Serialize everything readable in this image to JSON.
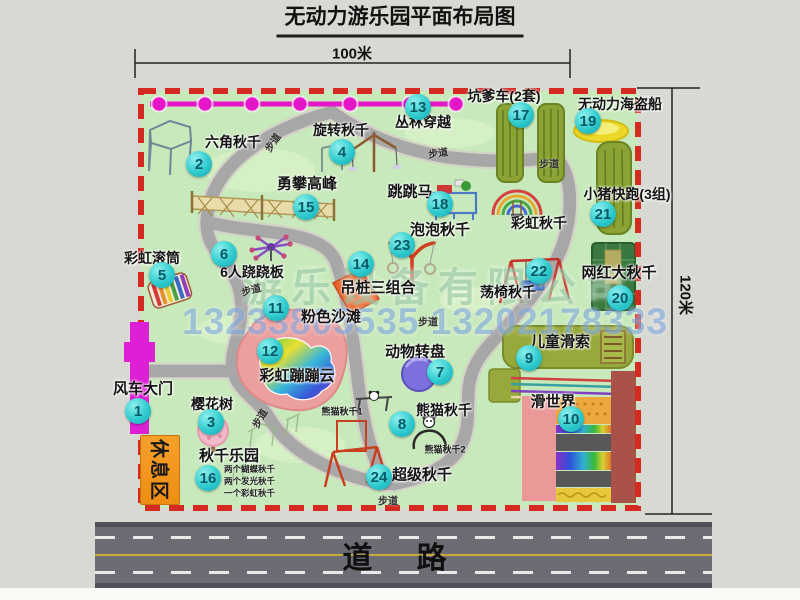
{
  "title": "无动力游乐园平面布局图",
  "dimensions": {
    "width_label": "100米",
    "height_label": "120米"
  },
  "road_label": "道 路",
  "rest_area_label": "休息区",
  "trail_label": "步道",
  "rainbow_swing_label": "彩虹秋千",
  "panda_swing_1": "熊猫秋千1",
  "panda_swing_2": "熊猫秋千2",
  "swing_park_notes": [
    "两个蝴蝶秋千",
    "两个发光秋千",
    "一个彩虹秋千"
  ],
  "watermark": {
    "company": "游乐设备有限公司",
    "phone": "13233805535 13202178333"
  },
  "items": [
    {
      "num": "1",
      "label": "风车大门"
    },
    {
      "num": "2",
      "label": "六角秋千"
    },
    {
      "num": "3",
      "label": "樱花树"
    },
    {
      "num": "4",
      "label": "旋转秋千"
    },
    {
      "num": "5",
      "label": "彩虹滚筒"
    },
    {
      "num": "6",
      "label": "6人跷跷板"
    },
    {
      "num": "7",
      "label": "动物转盘"
    },
    {
      "num": "8",
      "label": "熊猫秋千"
    },
    {
      "num": "9",
      "label": "儿童滑索"
    },
    {
      "num": "10",
      "label": "滑世界"
    },
    {
      "num": "11",
      "label": "粉色沙滩"
    },
    {
      "num": "12",
      "label": "彩虹蹦蹦云"
    },
    {
      "num": "13",
      "label": "丛林穿越"
    },
    {
      "num": "14",
      "label": "吊桩三组合"
    },
    {
      "num": "15",
      "label": "勇攀高峰"
    },
    {
      "num": "16",
      "label": "秋千乐园"
    },
    {
      "num": "17",
      "label": "坑爹车(2套)"
    },
    {
      "num": "18",
      "label": "跳跳马"
    },
    {
      "num": "19",
      "label": "无动力海盗船"
    },
    {
      "num": "20",
      "label": "网红大秋千"
    },
    {
      "num": "21",
      "label": "小猪快跑(3组)"
    },
    {
      "num": "22",
      "label": "荡椅秋千"
    },
    {
      "num": "23",
      "label": "泡泡秋千"
    },
    {
      "num": "24",
      "label": "超级秋千"
    }
  ],
  "colors": {
    "border_dashed": "#d42a22",
    "map_green": "#c8e9bb",
    "path_gray": "#a7a7a7",
    "badge_cyan": "#2fcbce",
    "gate_magenta": "#dd1fd5",
    "zipline_magenta": "#e416c8",
    "rest_orange": "#ee8d14",
    "road_gray": "#6c6c74"
  }
}
